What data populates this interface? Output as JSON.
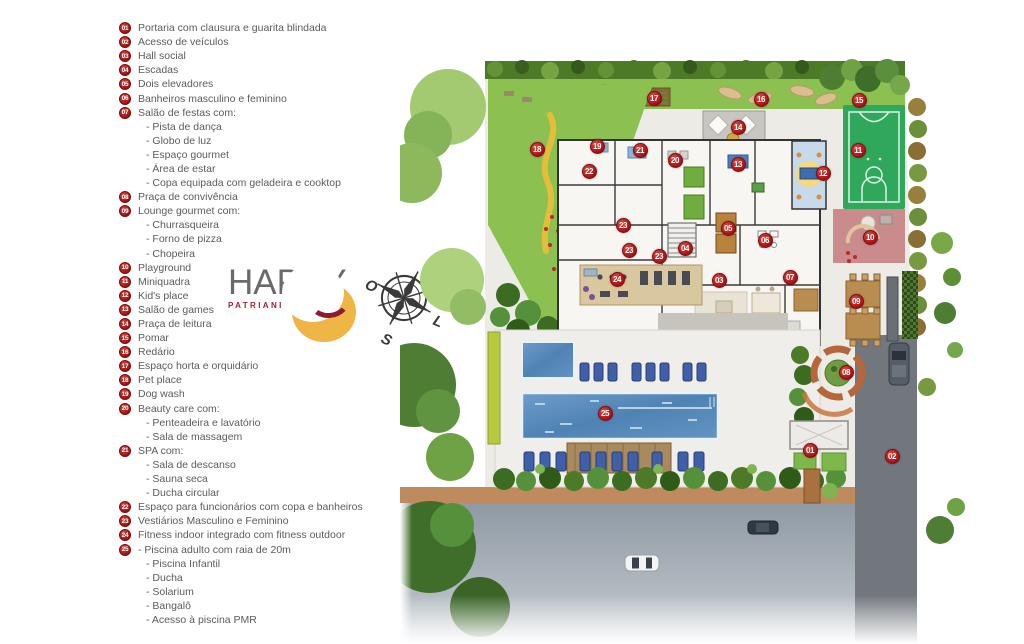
{
  "legend": {
    "items": [
      {
        "num": "01",
        "label": "Portaria com clausura e guarita blindada"
      },
      {
        "num": "02",
        "label": "Acesso de veículos"
      },
      {
        "num": "03",
        "label": "Hall social"
      },
      {
        "num": "04",
        "label": "Escadas"
      },
      {
        "num": "05",
        "label": "Dois elevadores"
      },
      {
        "num": "06",
        "label": "Banheiros masculino e feminino"
      },
      {
        "num": "07",
        "label": "Salão de festas com:",
        "subs": [
          "- Pista de dança",
          "- Globo de luz",
          "- Espaço gourmet",
          "- Área de estar",
          "- Copa equipada com geladeira e cooktop"
        ]
      },
      {
        "num": "08",
        "label": "Praça de convivência"
      },
      {
        "num": "09",
        "label": "Lounge gourmet com:",
        "subs": [
          "- Churrasqueira",
          "- Forno de pizza",
          "- Chopeira"
        ]
      },
      {
        "num": "10",
        "label": "Playground"
      },
      {
        "num": "11",
        "label": "Miniquadra"
      },
      {
        "num": "12",
        "label": "Kid's place"
      },
      {
        "num": "13",
        "label": "Salão de games"
      },
      {
        "num": "14",
        "label": "Praça de leitura"
      },
      {
        "num": "15",
        "label": "Pomar"
      },
      {
        "num": "16",
        "label": "Redário"
      },
      {
        "num": "17",
        "label": "Espaço horta e orquidário"
      },
      {
        "num": "18",
        "label": "Pet place"
      },
      {
        "num": "19",
        "label": "Dog wash"
      },
      {
        "num": "20",
        "label": "Beauty care com:",
        "subs": [
          "- Penteadeira e lavatório",
          "- Sala de massagem"
        ]
      },
      {
        "num": "21",
        "label": "SPA com:",
        "subs": [
          "- Sala de descanso",
          "- Sauna seca",
          "- Ducha circular"
        ]
      },
      {
        "num": "22",
        "label": "Espaço para funcionários com copa e banheiros"
      },
      {
        "num": "23",
        "label": "Vestiários Masculino e Feminino"
      },
      {
        "num": "24",
        "label": "Fitness indoor integrado com fitness outdoor"
      },
      {
        "num": "25",
        "label": "- Piscina adulto com raia de 20m",
        "subs": [
          "- Piscina Infantil",
          "- Ducha",
          "- Solarium",
          "- Bangalô",
          "- Acesso à piscina PMR"
        ]
      }
    ]
  },
  "logo": {
    "title": "HAPPY",
    "subtitle": "PATRIANI"
  },
  "compass": {
    "n": "N",
    "s": "S",
    "o": "O",
    "l": "L"
  },
  "plan": {
    "markers": [
      {
        "n": "01",
        "x": 410,
        "y": 395
      },
      {
        "n": "02",
        "x": 492,
        "y": 401
      },
      {
        "n": "03",
        "x": 319,
        "y": 225
      },
      {
        "n": "04",
        "x": 285,
        "y": 193
      },
      {
        "n": "05",
        "x": 328,
        "y": 173
      },
      {
        "n": "06",
        "x": 365,
        "y": 185
      },
      {
        "n": "07",
        "x": 390,
        "y": 222
      },
      {
        "n": "08",
        "x": 446,
        "y": 317
      },
      {
        "n": "09",
        "x": 456,
        "y": 246
      },
      {
        "n": "10",
        "x": 470,
        "y": 182
      },
      {
        "n": "11",
        "x": 458,
        "y": 95
      },
      {
        "n": "12",
        "x": 423,
        "y": 118
      },
      {
        "n": "13",
        "x": 338,
        "y": 109
      },
      {
        "n": "14",
        "x": 338,
        "y": 72
      },
      {
        "n": "15",
        "x": 459,
        "y": 45
      },
      {
        "n": "16",
        "x": 361,
        "y": 44
      },
      {
        "n": "17",
        "x": 254,
        "y": 43
      },
      {
        "n": "18",
        "x": 137,
        "y": 94
      },
      {
        "n": "19",
        "x": 197,
        "y": 91
      },
      {
        "n": "20",
        "x": 275,
        "y": 105
      },
      {
        "n": "21",
        "x": 240,
        "y": 95
      },
      {
        "n": "22",
        "x": 189,
        "y": 116
      },
      {
        "n": "23",
        "x": 223,
        "y": 170
      },
      {
        "n": "23",
        "x": 229,
        "y": 195
      },
      {
        "n": "23",
        "x": 259,
        "y": 201
      },
      {
        "n": "24",
        "x": 217,
        "y": 224
      },
      {
        "n": "25",
        "x": 205,
        "y": 358
      }
    ]
  },
  "colors": {
    "accent_red": "#b01217",
    "lawn_green": "#8cc152",
    "pool_blue": "#5b8fc0",
    "court_green": "#2fa85c",
    "playground_pink": "#c98b8b",
    "road_gray": "#97a2ac",
    "sidewalk_tan": "#bf8a5e",
    "logo_gold": "#efb545",
    "logo_wine": "#8e1b33"
  }
}
